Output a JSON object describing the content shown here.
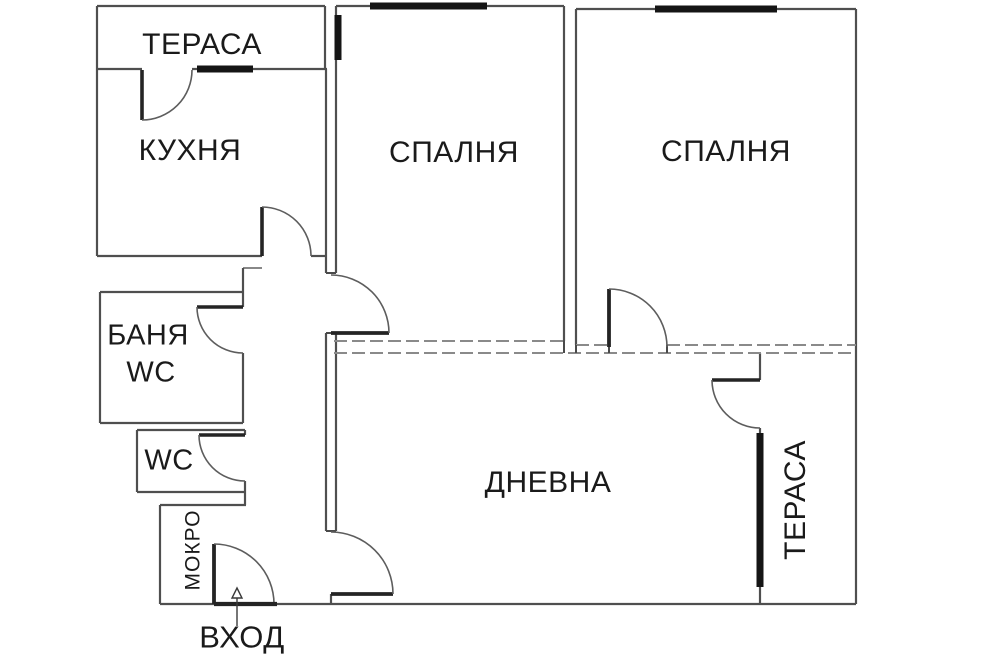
{
  "plan_type": "apartment-floor-plan",
  "rooms": {
    "terrace_top": {
      "label": "ТЕРАСА"
    },
    "kitchen": {
      "label": "КУХНЯ"
    },
    "bedroom_middle": {
      "label": "СПАЛНЯ"
    },
    "bedroom_right": {
      "label": "СПАЛНЯ"
    },
    "bathroom": {
      "label_line1": "БАНЯ",
      "label_line2": "WC"
    },
    "toilet": {
      "label": "WC"
    },
    "wet_room": {
      "label": "МОКРО"
    },
    "living_room": {
      "label": "ДНЕВНА"
    },
    "terrace_right": {
      "label": "ТЕРАСА"
    },
    "entrance": {
      "label": "ВХОД"
    }
  },
  "colors": {
    "background": "#ffffff",
    "wall": "#4f4f4f",
    "faded_wall": "#8a8a8a",
    "door_leaf": "#242424",
    "door_arc": "#5d5d5d",
    "window": "#151515",
    "text": "#1a1a1a"
  }
}
